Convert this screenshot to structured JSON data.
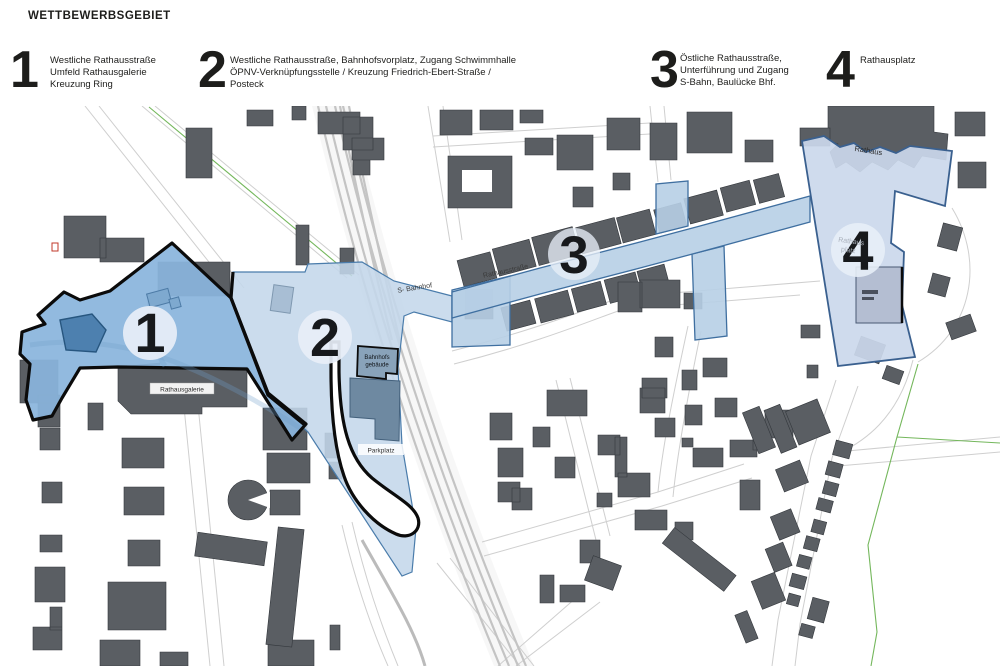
{
  "title": "WETTBEWERBSGEBIET",
  "legend": {
    "items": [
      {
        "number": "1",
        "text": "Westliche Rathausstraße\nUmfeld Rathausgalerie\nKreuzung Ring"
      },
      {
        "number": "2",
        "text": "Westliche Rathausstraße, Bahnhofsvorplatz, Zugang Schwimmhalle\nÖPNV-Verknüpfungsstelle / Kreuzung Friedrich-Ebert-Straße /\nPosteck"
      },
      {
        "number": "3",
        "text": "Östliche Rathausstraße,\nUnterführung und Zugang\nS-Bahn, Baulücke Bhf."
      },
      {
        "number": "4",
        "text": "Rathausplatz"
      }
    ]
  },
  "map": {
    "markers": [
      {
        "number": "1"
      },
      {
        "number": "2"
      },
      {
        "number": "3"
      },
      {
        "number": "4"
      }
    ],
    "labels": {
      "rathausgalerie": "Rathausgalerie",
      "bahnhof_line1": "Bahnhofs",
      "bahnhof_line2": "gebäude",
      "parkplatz": "Parkplatz",
      "s_bahnhof": "S- Bahnhof",
      "rathausstrasse": "Rathausstraße",
      "rathaus": "Rathaus",
      "rathausplatz_line1": "Rathaus",
      "rathausplatz_line2": "platz"
    }
  },
  "colors": {
    "zone1": "#8ab5dd",
    "zone2": "#c3d7ea",
    "zone3": "#b7cfe6",
    "zone4": "#cbd8ec",
    "zone_border_dark": "#0b0b0b",
    "zone_border_blue": "#3f6fa0",
    "building": "#5a5e63",
    "circle": "#e7eef7",
    "number": "#17191c",
    "track": "#c4c4c4",
    "street": "#cfcfcf",
    "green": "#74b75c",
    "red_symbol": "#c0392b"
  }
}
